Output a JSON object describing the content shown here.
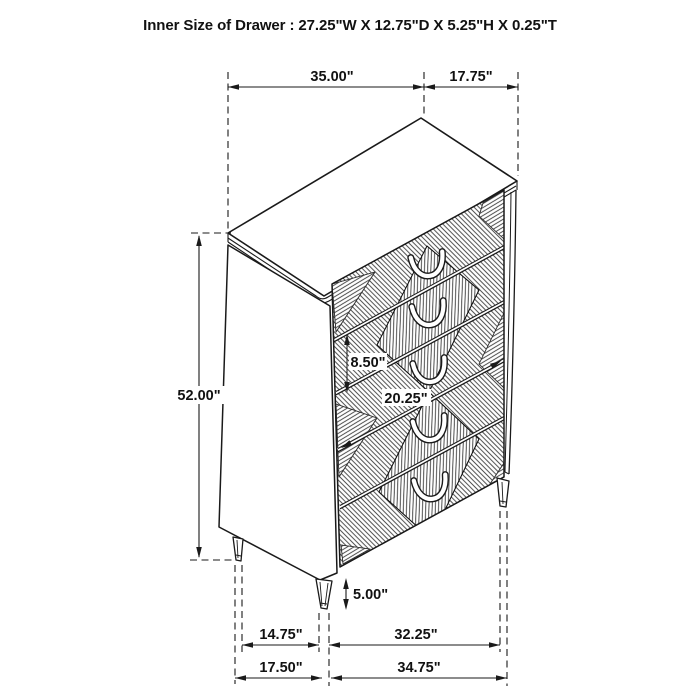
{
  "title": "Inner Size of Drawer : 27.25\"W X 12.75\"D X 5.25\"H X 0.25\"T",
  "dimension_labels": {
    "top_width": "35.00\"",
    "top_depth": "17.75\"",
    "overall_height": "52.00\"",
    "drawer_front_height": "8.50\"",
    "drawer_row_width": "20.25\"",
    "leg_height": "5.00\"",
    "side_leg_spacing_inner": "14.75\"",
    "front_leg_spacing_inner": "32.25\"",
    "side_leg_spacing_outer": "17.50\"",
    "front_leg_spacing_outer": "34.75\""
  },
  "colors": {
    "line": "#1a1a1a",
    "background": "#ffffff",
    "hatch": "#222222"
  }
}
